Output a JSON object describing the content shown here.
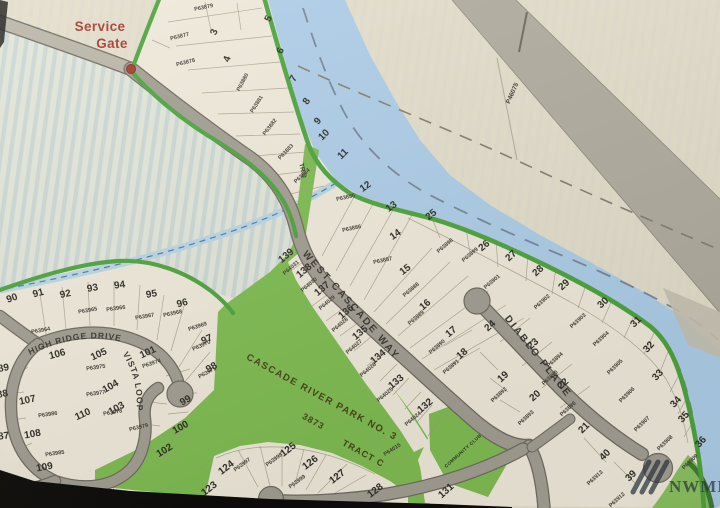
{
  "map": {
    "type": "plat-map-photo",
    "title_text": "CASCADE RIVER PARK NO. 3",
    "survey_number": "3873",
    "tract_label": "TRACT C",
    "tract_d_label": "TR D",
    "community_club_label": "COMMUNITY CLUB",
    "highway_parcel": "P46075",
    "watermark": "NWMLS",
    "service_gate": {
      "line1": "Service",
      "line2": "Gate"
    },
    "streets": {
      "west_cascade_way": "WEST CASCADE WAY",
      "high_ridge_drive": "HIGH RIDGE DRIVE",
      "vista_loop": "VISTA LOOP",
      "diablo_place": "DIABLO PLACE"
    },
    "colors": {
      "green": "#4ea43e",
      "river": "#aecde8",
      "road": "#a39e93",
      "tract": "#7fbc52",
      "gate": "#a63a2c",
      "wm": "#2c3740"
    },
    "lot_numbers": [
      {
        "n": "3",
        "x": 217,
        "y": 33,
        "r": -70
      },
      {
        "n": "4",
        "x": 230,
        "y": 60,
        "r": -70
      },
      {
        "n": "5",
        "x": 271,
        "y": 20,
        "r": -62
      },
      {
        "n": "6",
        "x": 283,
        "y": 52,
        "r": -62
      },
      {
        "n": "7",
        "x": 296,
        "y": 80,
        "r": -60
      },
      {
        "n": "8",
        "x": 309,
        "y": 103,
        "r": -55
      },
      {
        "n": "9",
        "x": 320,
        "y": 123,
        "r": -50
      },
      {
        "n": "10",
        "x": 326,
        "y": 137,
        "r": -45
      },
      {
        "n": "11",
        "x": 345,
        "y": 156,
        "r": -45
      },
      {
        "n": "12",
        "x": 367,
        "y": 189,
        "r": -35
      },
      {
        "n": "13",
        "x": 393,
        "y": 209,
        "r": -35
      },
      {
        "n": "14",
        "x": 397,
        "y": 237,
        "r": -35
      },
      {
        "n": "15",
        "x": 407,
        "y": 272,
        "r": -38
      },
      {
        "n": "16",
        "x": 427,
        "y": 307,
        "r": -40
      },
      {
        "n": "17",
        "x": 453,
        "y": 334,
        "r": -40
      },
      {
        "n": "18",
        "x": 464,
        "y": 356,
        "r": -40
      },
      {
        "n": "19",
        "x": 505,
        "y": 379,
        "r": -42
      },
      {
        "n": "20",
        "x": 537,
        "y": 398,
        "r": -42
      },
      {
        "n": "21",
        "x": 586,
        "y": 430,
        "r": -45
      },
      {
        "n": "22",
        "x": 565,
        "y": 386,
        "r": -42
      },
      {
        "n": "23",
        "x": 535,
        "y": 346,
        "r": -42
      },
      {
        "n": "24",
        "x": 492,
        "y": 328,
        "r": -42
      },
      {
        "n": "25",
        "x": 433,
        "y": 217,
        "r": -40
      },
      {
        "n": "26",
        "x": 486,
        "y": 248,
        "r": -40
      },
      {
        "n": "27",
        "x": 513,
        "y": 258,
        "r": -42
      },
      {
        "n": "28",
        "x": 540,
        "y": 273,
        "r": -42
      },
      {
        "n": "29",
        "x": 566,
        "y": 287,
        "r": -42
      },
      {
        "n": "30",
        "x": 605,
        "y": 305,
        "r": -42
      },
      {
        "n": "31",
        "x": 638,
        "y": 324,
        "r": -45
      },
      {
        "n": "32",
        "x": 651,
        "y": 349,
        "r": -48
      },
      {
        "n": "33",
        "x": 660,
        "y": 377,
        "r": -48
      },
      {
        "n": "34",
        "x": 678,
        "y": 404,
        "r": -48
      },
      {
        "n": "35",
        "x": 686,
        "y": 419,
        "r": -48
      },
      {
        "n": "36",
        "x": 703,
        "y": 444,
        "r": -48
      },
      {
        "n": "39",
        "x": 633,
        "y": 478,
        "r": -45
      },
      {
        "n": "40",
        "x": 607,
        "y": 457,
        "r": -45
      },
      {
        "n": "86",
        "x": 6,
        "y": 483,
        "r": -8
      },
      {
        "n": "87",
        "x": 4,
        "y": 439,
        "r": -8
      },
      {
        "n": "88",
        "x": 3,
        "y": 397,
        "r": -10
      },
      {
        "n": "89",
        "x": 4,
        "y": 371,
        "r": -10
      },
      {
        "n": "90",
        "x": 13,
        "y": 301,
        "r": -20
      },
      {
        "n": "91",
        "x": 39,
        "y": 296,
        "r": -15
      },
      {
        "n": "92",
        "x": 66,
        "y": 297,
        "r": -12
      },
      {
        "n": "93",
        "x": 93,
        "y": 291,
        "r": -10
      },
      {
        "n": "94",
        "x": 120,
        "y": 288,
        "r": -8
      },
      {
        "n": "95",
        "x": 152,
        "y": 297,
        "r": -10
      },
      {
        "n": "96",
        "x": 183,
        "y": 306,
        "r": -15
      },
      {
        "n": "97",
        "x": 208,
        "y": 342,
        "r": -25
      },
      {
        "n": "98",
        "x": 213,
        "y": 370,
        "r": -30
      },
      {
        "n": "99",
        "x": 187,
        "y": 403,
        "r": -30
      },
      {
        "n": "100",
        "x": 182,
        "y": 430,
        "r": -30
      },
      {
        "n": "101",
        "x": 149,
        "y": 355,
        "r": -25
      },
      {
        "n": "102",
        "x": 166,
        "y": 453,
        "r": -32
      },
      {
        "n": "103",
        "x": 118,
        "y": 411,
        "r": -30
      },
      {
        "n": "104",
        "x": 112,
        "y": 389,
        "r": -30
      },
      {
        "n": "105",
        "x": 100,
        "y": 357,
        "r": -25
      },
      {
        "n": "106",
        "x": 58,
        "y": 357,
        "r": -15
      },
      {
        "n": "107",
        "x": 28,
        "y": 403,
        "r": -12
      },
      {
        "n": "108",
        "x": 33,
        "y": 437,
        "r": -10
      },
      {
        "n": "109",
        "x": 45,
        "y": 470,
        "r": -10
      },
      {
        "n": "110",
        "x": 84,
        "y": 417,
        "r": -25
      },
      {
        "n": "123",
        "x": 211,
        "y": 491,
        "r": -38
      },
      {
        "n": "124",
        "x": 228,
        "y": 470,
        "r": -38
      },
      {
        "n": "125",
        "x": 290,
        "y": 452,
        "r": -38
      },
      {
        "n": "126",
        "x": 312,
        "y": 465,
        "r": -38
      },
      {
        "n": "127",
        "x": 339,
        "y": 479,
        "r": -38
      },
      {
        "n": "128",
        "x": 377,
        "y": 493,
        "r": -38
      },
      {
        "n": "131",
        "x": 448,
        "y": 493,
        "r": -42
      },
      {
        "n": "132",
        "x": 427,
        "y": 408,
        "r": -40
      },
      {
        "n": "133",
        "x": 398,
        "y": 384,
        "r": -40
      },
      {
        "n": "134",
        "x": 380,
        "y": 359,
        "r": -40
      },
      {
        "n": "135",
        "x": 362,
        "y": 335,
        "r": -40
      },
      {
        "n": "136",
        "x": 348,
        "y": 314,
        "r": -40
      },
      {
        "n": "137",
        "x": 324,
        "y": 291,
        "r": -40
      },
      {
        "n": "138",
        "x": 306,
        "y": 273,
        "r": -40
      },
      {
        "n": "139",
        "x": 288,
        "y": 258,
        "r": -40
      }
    ],
    "parcel_numbers": [
      {
        "n": "P63877",
        "x": 180,
        "y": 38,
        "r": -14
      },
      {
        "n": "P63878",
        "x": 186,
        "y": 64,
        "r": -14
      },
      {
        "n": "P63879",
        "x": 204,
        "y": 9,
        "r": -12
      },
      {
        "n": "P63880",
        "x": 244,
        "y": 83,
        "r": -62
      },
      {
        "n": "P63881",
        "x": 258,
        "y": 105,
        "r": -58
      },
      {
        "n": "P63882",
        "x": 271,
        "y": 128,
        "r": -52
      },
      {
        "n": "P63883",
        "x": 287,
        "y": 153,
        "r": -46
      },
      {
        "n": "P63884",
        "x": 303,
        "y": 177,
        "r": -42
      },
      {
        "n": "P63885",
        "x": 346,
        "y": 199,
        "r": -12
      },
      {
        "n": "P63886",
        "x": 352,
        "y": 230,
        "r": -12
      },
      {
        "n": "P63887",
        "x": 383,
        "y": 262,
        "r": -12
      },
      {
        "n": "P63888",
        "x": 412,
        "y": 291,
        "r": -40
      },
      {
        "n": "P63889",
        "x": 417,
        "y": 319,
        "r": -40
      },
      {
        "n": "P63890",
        "x": 438,
        "y": 348,
        "r": -40
      },
      {
        "n": "P63891",
        "x": 452,
        "y": 368,
        "r": -40
      },
      {
        "n": "P63892",
        "x": 500,
        "y": 396,
        "r": -42
      },
      {
        "n": "P63893",
        "x": 527,
        "y": 419,
        "r": -42
      },
      {
        "n": "P63894",
        "x": 556,
        "y": 361,
        "r": -42
      },
      {
        "n": "P63895",
        "x": 551,
        "y": 379,
        "r": -42
      },
      {
        "n": "P63896",
        "x": 569,
        "y": 410,
        "r": -42
      },
      {
        "n": "P63898",
        "x": 446,
        "y": 247,
        "r": -40
      },
      {
        "n": "P63899",
        "x": 471,
        "y": 256,
        "r": -40
      },
      {
        "n": "P63901",
        "x": 493,
        "y": 283,
        "r": -40
      },
      {
        "n": "P63902",
        "x": 543,
        "y": 303,
        "r": -42
      },
      {
        "n": "P63903",
        "x": 579,
        "y": 322,
        "r": -42
      },
      {
        "n": "P63904",
        "x": 602,
        "y": 340,
        "r": -42
      },
      {
        "n": "P63905",
        "x": 616,
        "y": 368,
        "r": -44
      },
      {
        "n": "P63906",
        "x": 628,
        "y": 396,
        "r": -44
      },
      {
        "n": "P63907",
        "x": 643,
        "y": 425,
        "r": -44
      },
      {
        "n": "P63908",
        "x": 666,
        "y": 444,
        "r": -44
      },
      {
        "n": "P63909",
        "x": 691,
        "y": 463,
        "r": -44
      },
      {
        "n": "P63912",
        "x": 618,
        "y": 501,
        "r": -42
      },
      {
        "n": "P63913",
        "x": 596,
        "y": 479,
        "r": -42
      },
      {
        "n": "P63964",
        "x": 41,
        "y": 332,
        "r": -10
      },
      {
        "n": "P63965",
        "x": 88,
        "y": 312,
        "r": -10
      },
      {
        "n": "P63966",
        "x": 116,
        "y": 310,
        "r": -8
      },
      {
        "n": "P63967",
        "x": 145,
        "y": 318,
        "r": -10
      },
      {
        "n": "P63968",
        "x": 173,
        "y": 315,
        "r": -12
      },
      {
        "n": "P63969",
        "x": 198,
        "y": 328,
        "r": -18
      },
      {
        "n": "P63970",
        "x": 202,
        "y": 347,
        "r": -24
      },
      {
        "n": "P63971",
        "x": 208,
        "y": 374,
        "r": -28
      },
      {
        "n": "P63974",
        "x": 152,
        "y": 365,
        "r": -18
      },
      {
        "n": "P63975",
        "x": 96,
        "y": 369,
        "r": -8
      },
      {
        "n": "P63977",
        "x": 96,
        "y": 395,
        "r": -8
      },
      {
        "n": "P63978",
        "x": 113,
        "y": 414,
        "r": -10
      },
      {
        "n": "P63979",
        "x": 139,
        "y": 429,
        "r": -14
      },
      {
        "n": "P63985",
        "x": 55,
        "y": 455,
        "r": -8
      },
      {
        "n": "P63986",
        "x": 48,
        "y": 416,
        "r": -8
      },
      {
        "n": "P63997",
        "x": 243,
        "y": 466,
        "r": -36
      },
      {
        "n": "P63998",
        "x": 275,
        "y": 461,
        "r": -36
      },
      {
        "n": "P63999",
        "x": 298,
        "y": 483,
        "r": -36
      },
      {
        "n": "P64015",
        "x": 393,
        "y": 451,
        "r": -32
      },
      {
        "n": "P64024",
        "x": 414,
        "y": 420,
        "r": -40
      },
      {
        "n": "P64025",
        "x": 386,
        "y": 396,
        "r": -40
      },
      {
        "n": "P64026",
        "x": 369,
        "y": 371,
        "r": -40
      },
      {
        "n": "P64027",
        "x": 355,
        "y": 348,
        "r": -40
      },
      {
        "n": "P64028",
        "x": 341,
        "y": 326,
        "r": -40
      },
      {
        "n": "P64029",
        "x": 328,
        "y": 304,
        "r": -40
      },
      {
        "n": "P64030",
        "x": 310,
        "y": 286,
        "r": -40
      },
      {
        "n": "P64031",
        "x": 292,
        "y": 269,
        "r": -40
      }
    ]
  }
}
